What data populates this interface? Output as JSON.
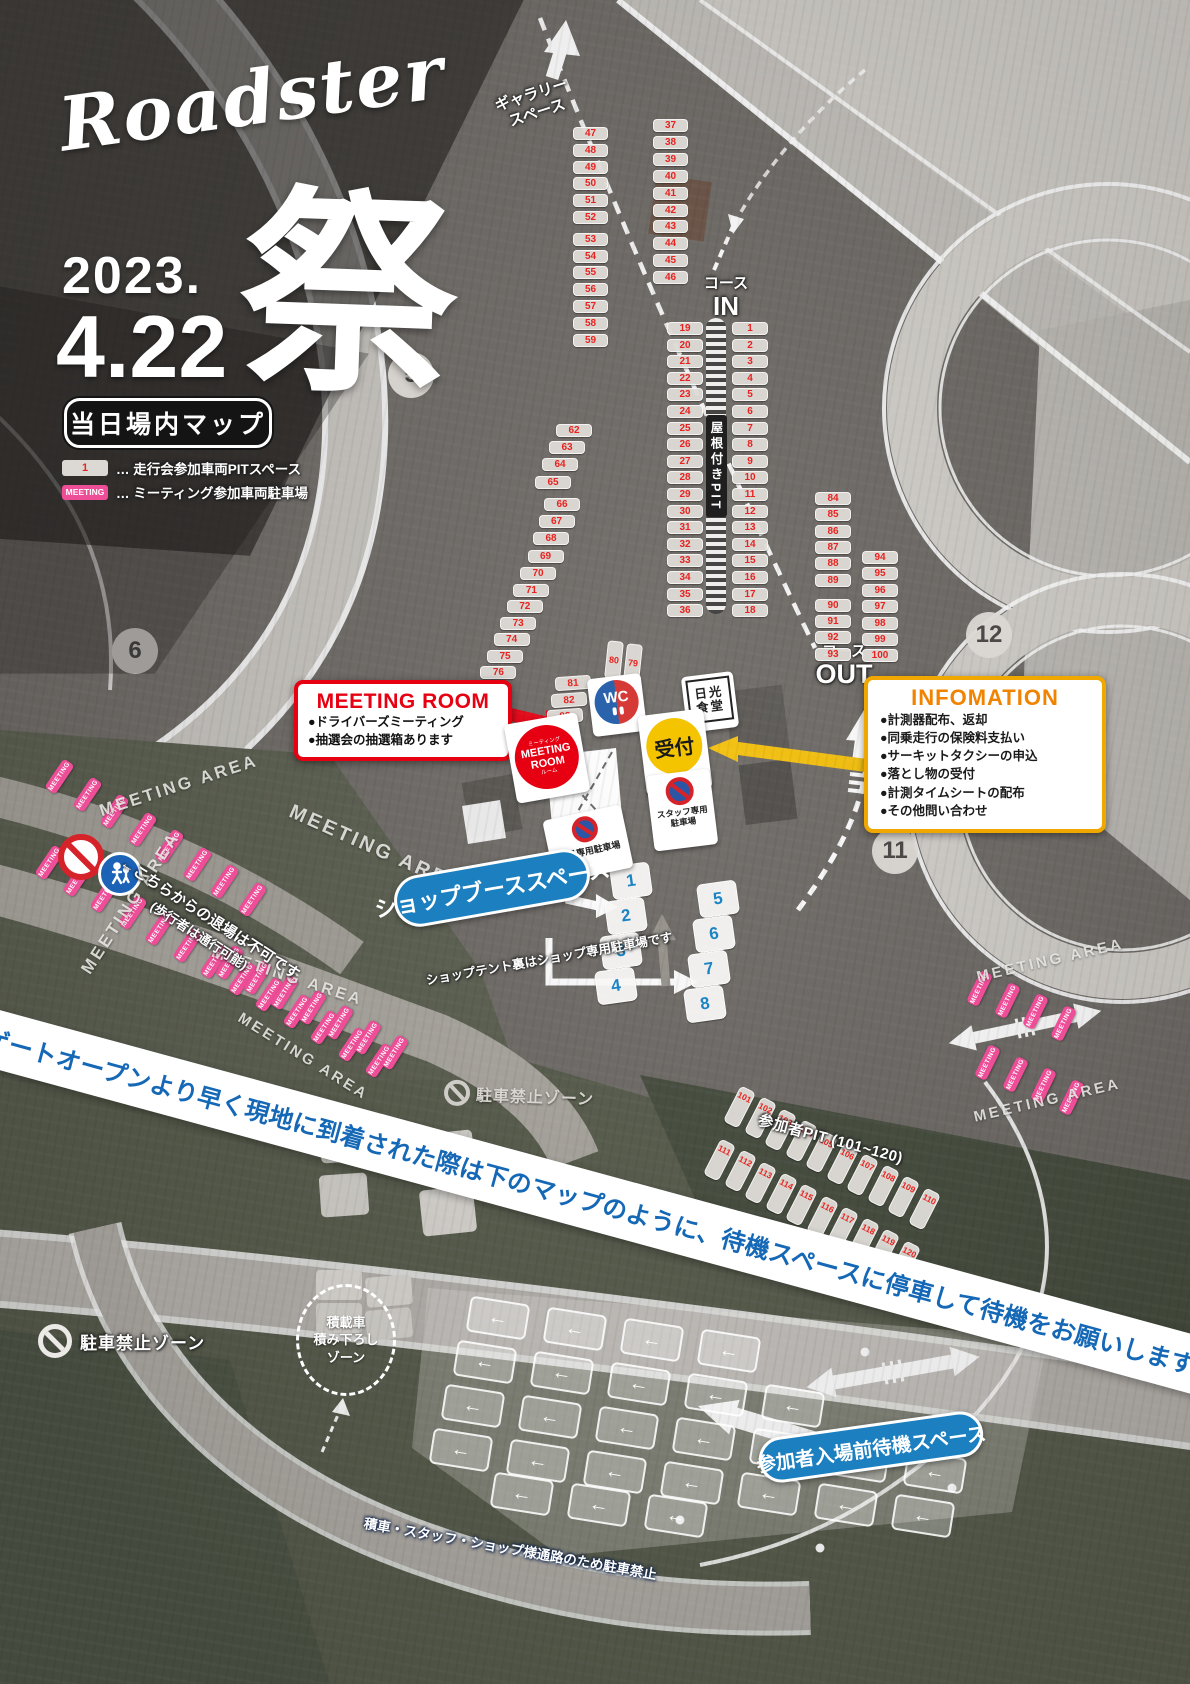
{
  "poster": {
    "brand_script": "Roadster",
    "brand_kanji": "祭",
    "date_year": "2023.",
    "date_day": "4.22",
    "map_title": "当日場内マップ"
  },
  "legend": {
    "pit_chip": "1",
    "pit_text": "… 走行会参加車両PITスペース",
    "meeting_chip": "MEETING",
    "meeting_text": "… ミーティング参加車両駐車場"
  },
  "corners": [
    "5",
    "6",
    "12",
    "11"
  ],
  "track_labels": {
    "gallery_line1": "ギャラリー",
    "gallery_line2": "スペース",
    "course_in_line1": "コース",
    "course_in_line2": "IN",
    "course_out_line1": "コース",
    "course_out_line2": "OUT",
    "roofed_pit": "屋根付きPIT"
  },
  "facilities": {
    "wc": "WC",
    "restaurant_line1": "日光",
    "restaurant_line2": "食堂",
    "reception": "受付",
    "employee_parking": "社員専用駐車場",
    "staff_parking_line1": "スタッフ専用",
    "staff_parking_line2": "駐車場"
  },
  "meeting_room": {
    "title": "MEETING ROOM",
    "bullet1": "●ドライバーズミーティング",
    "bullet2": "●抽選会の抽選箱あります",
    "badge_top": "ミーティング",
    "badge_line1": "MEETING",
    "badge_line2": "ROOM",
    "badge_bottom": "ルーム"
  },
  "information": {
    "title": "INFOMATION",
    "items": [
      "●計測器配布、返却",
      "●同乗走行の保険料支払い",
      "●サーキットタクシーの申込",
      "●落とし物の受付",
      "●計測タイムシートの配布",
      "●その他問い合わせ"
    ]
  },
  "shop": {
    "pill": "ショップブーススペース",
    "note": "ショップテント裏はショップ専用駐車場です"
  },
  "meeting_area": {
    "tag": "MEETING",
    "area_text": "MEETING AREA",
    "exit_line1": "←こちらからの退場は不可です",
    "exit_line2": "(歩行者は通行可能)"
  },
  "zones": {
    "no_parking": "駐車禁止ゾーン",
    "participant_pit": "参加者PIT (101~120)",
    "loading_line1": "積載車",
    "loading_line2": "積み下ろし",
    "loading_line3": "ゾーン",
    "waiting_pill": "参加者入場前待機スペース",
    "bottom_note": "積車・スタッフ・ショップ様通路のため駐車禁止",
    "banner": "ゲートオープンより早く現地に到着された際は下のマップのように、待機スペースに停車して待機をお願いします"
  },
  "pits": {
    "col_47_59": [
      47,
      48,
      49,
      50,
      51,
      52,
      53,
      54,
      55,
      56,
      57,
      58,
      59
    ],
    "col_37_46": [
      37,
      38,
      39,
      40,
      41,
      42,
      43,
      44,
      45,
      46
    ],
    "col_19_36": [
      19,
      20,
      21,
      22,
      23,
      24,
      25,
      26,
      27,
      28,
      29,
      30,
      31,
      32,
      33,
      34,
      35,
      36
    ],
    "col_1_18": [
      1,
      2,
      3,
      4,
      5,
      6,
      7,
      8,
      9,
      10,
      11,
      12,
      13,
      14,
      15,
      16,
      17,
      18
    ],
    "left_62_65": [
      62,
      63,
      64,
      65
    ],
    "left_66_69": [
      66,
      67,
      68,
      69
    ],
    "left_70_77": [
      70,
      71,
      72,
      73,
      74,
      75,
      76,
      77
    ],
    "right_84_93": [
      84,
      85,
      86,
      87,
      88,
      89,
      90,
      91,
      92,
      93
    ],
    "right_94_100": [
      94,
      95,
      96,
      97,
      98,
      99,
      100
    ],
    "pair_80_79": [
      80,
      79
    ],
    "diag_81_83": [
      81,
      82,
      83
    ],
    "shop_1_4": [
      1,
      2,
      3,
      4
    ],
    "shop_5_8": [
      5,
      6,
      7,
      8
    ],
    "row_101_110": [
      101,
      102,
      103,
      104,
      105,
      106,
      107,
      108,
      109,
      110
    ],
    "row_111_120": [
      111,
      112,
      113,
      114,
      115,
      116,
      117,
      118,
      119,
      120
    ]
  },
  "colors": {
    "pit_number": "#e8231f",
    "shop_number": "#1b84c4",
    "meeting_pink": "#ee4d97",
    "reception_yellow": "#f5c400",
    "info_border": "#f0a800",
    "info_title": "#f08300",
    "alert_red": "#e60012",
    "banner_blue": "#1568b6",
    "pill_blue": "#1b7fc0"
  }
}
